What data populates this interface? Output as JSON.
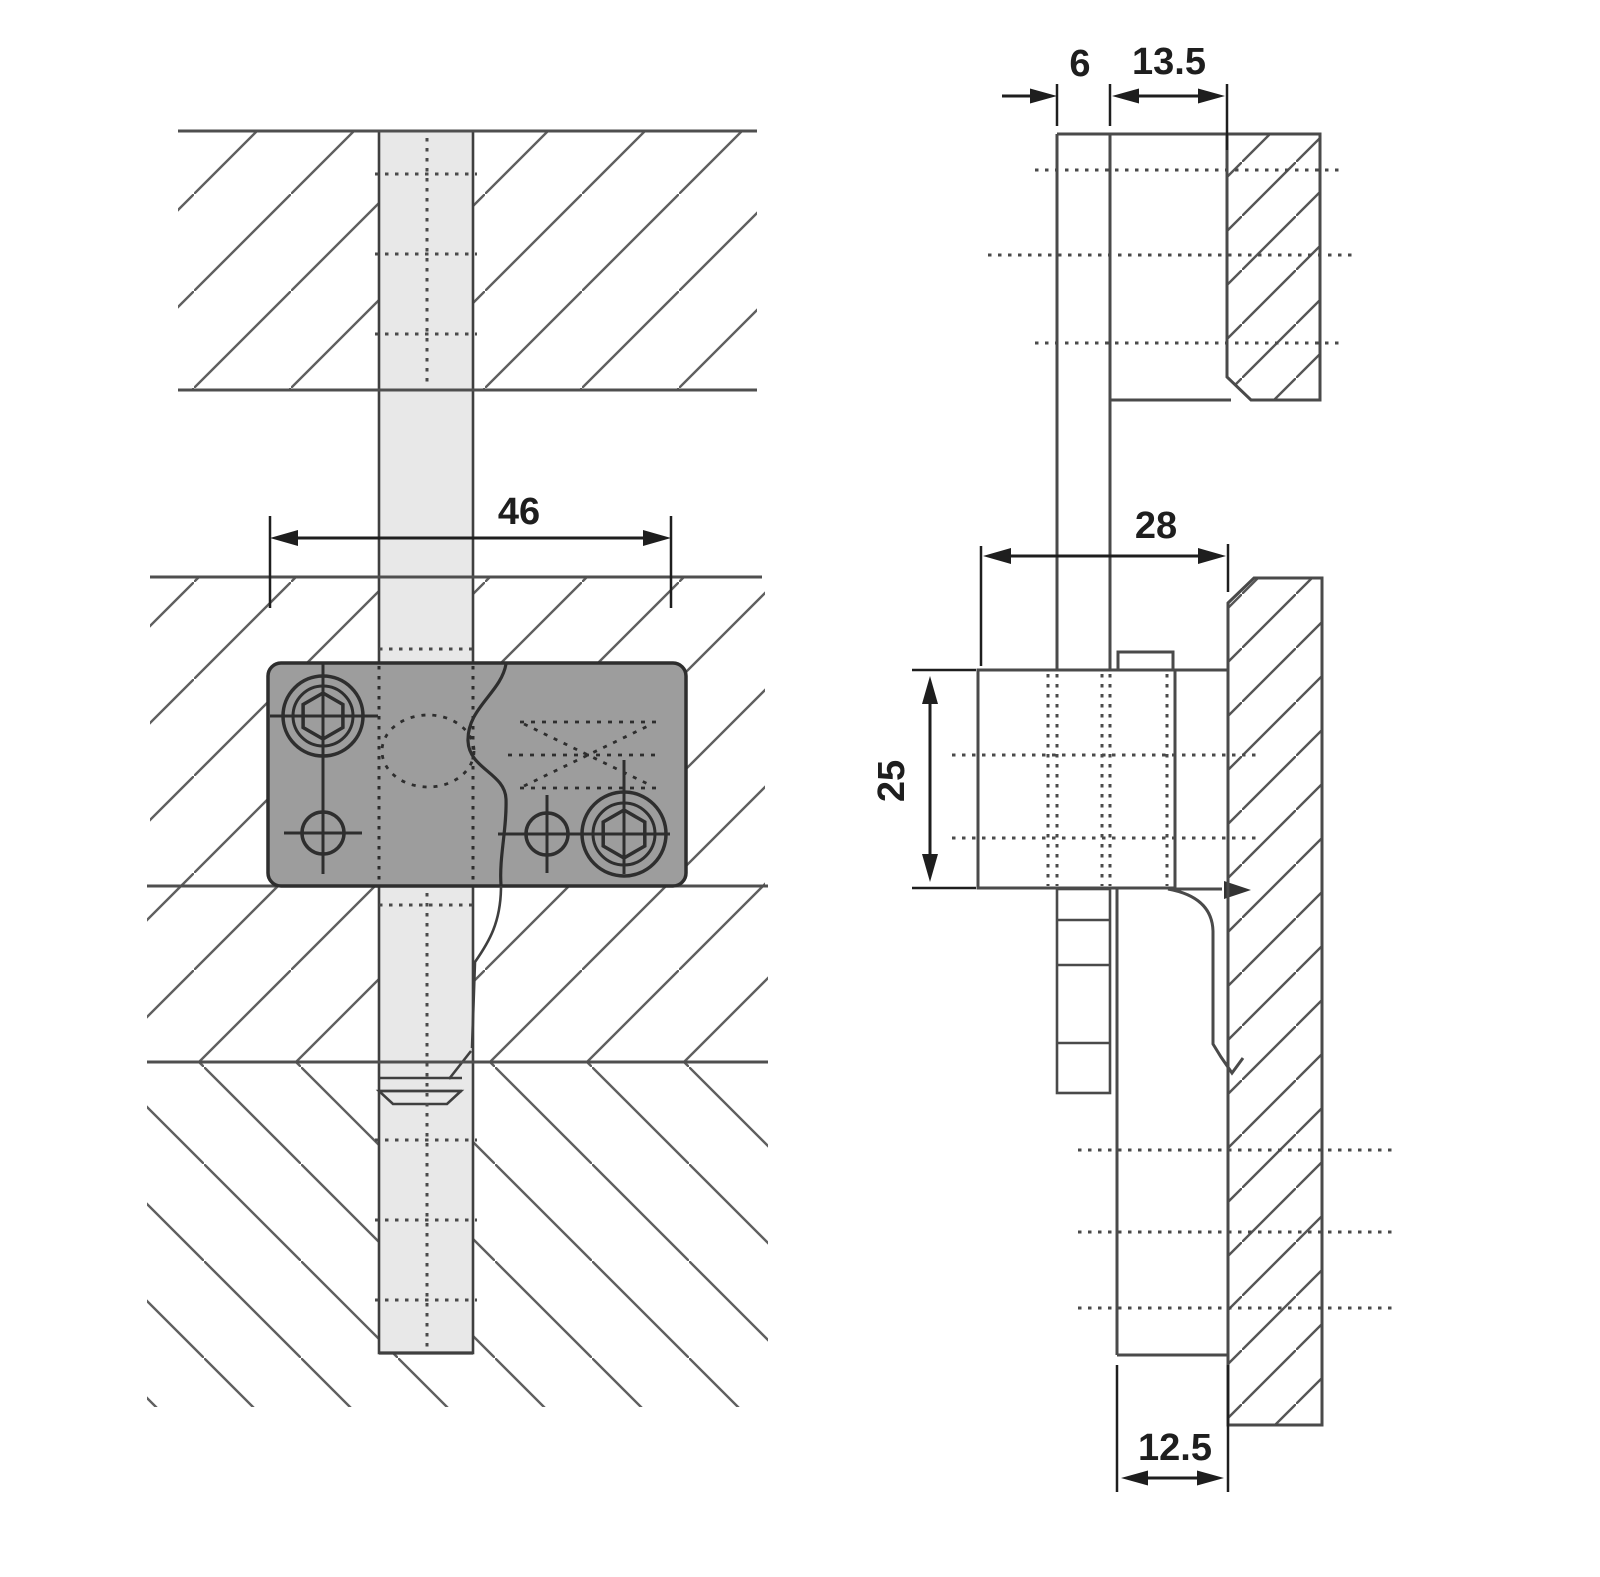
{
  "drawing": {
    "background": "#ffffff",
    "line_color": "#4a4a4a",
    "dim_color": "#1e1e1e",
    "bar_fill": "#e8e8e8",
    "plate_fill": "#9d9d9d",
    "dimensions": {
      "front_plate_width": "46",
      "side_offset": "6",
      "side_top_depth": "13.5",
      "side_body_depth": "28",
      "side_body_height": "25",
      "side_bottom_thickness": "12.5"
    }
  }
}
